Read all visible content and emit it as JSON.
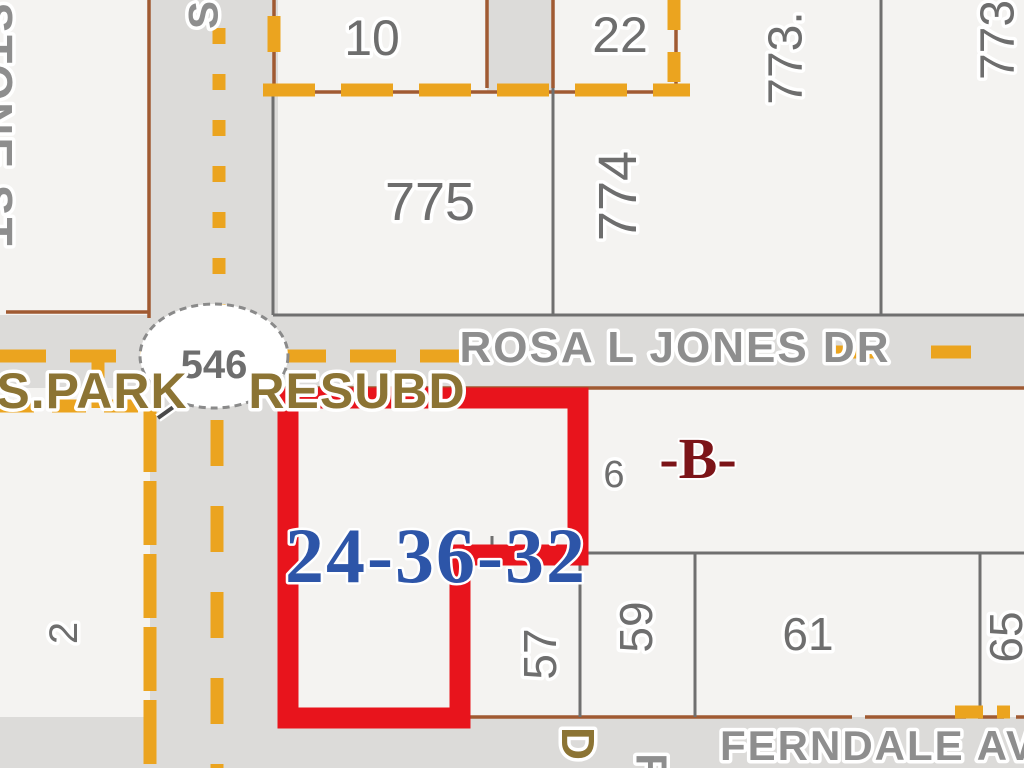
{
  "map": {
    "title": "parcel map with highlighted lot",
    "parcels": {
      "p10": "10",
      "p22": "22",
      "p775": "775",
      "p774": "774",
      "p773a": "773.",
      "p773b": "773",
      "p57": "57",
      "p59": "59",
      "p61": "61",
      "p65": "65",
      "p2": "2",
      "p6": "6"
    },
    "streets": {
      "rosa": "ROSA L JONES DR",
      "ferndale": "FERNDALE AV",
      "stone": "STONE ST",
      "s_fragment": "S",
      "r_fragment": "R"
    },
    "subdivision": {
      "part1": "S.PARK",
      "part2": "RESUBD",
      "d_fragment": "D"
    },
    "section_label": "24-36-32",
    "block_label": "-B-",
    "route_oval": "546",
    "colors": {
      "red": "#e8141c",
      "blue": "#2d55a8",
      "dkred": "#7c1418",
      "orange": "#eba41f",
      "brown": "#a05a32",
      "grayline": "#6f6f6f",
      "num": "#6e6e6e",
      "street": "#8e8e8e",
      "tan": "#8c7434",
      "road": "#dcdbd9",
      "parcel": "#f4f3f1",
      "halo": "#ffffff"
    }
  }
}
